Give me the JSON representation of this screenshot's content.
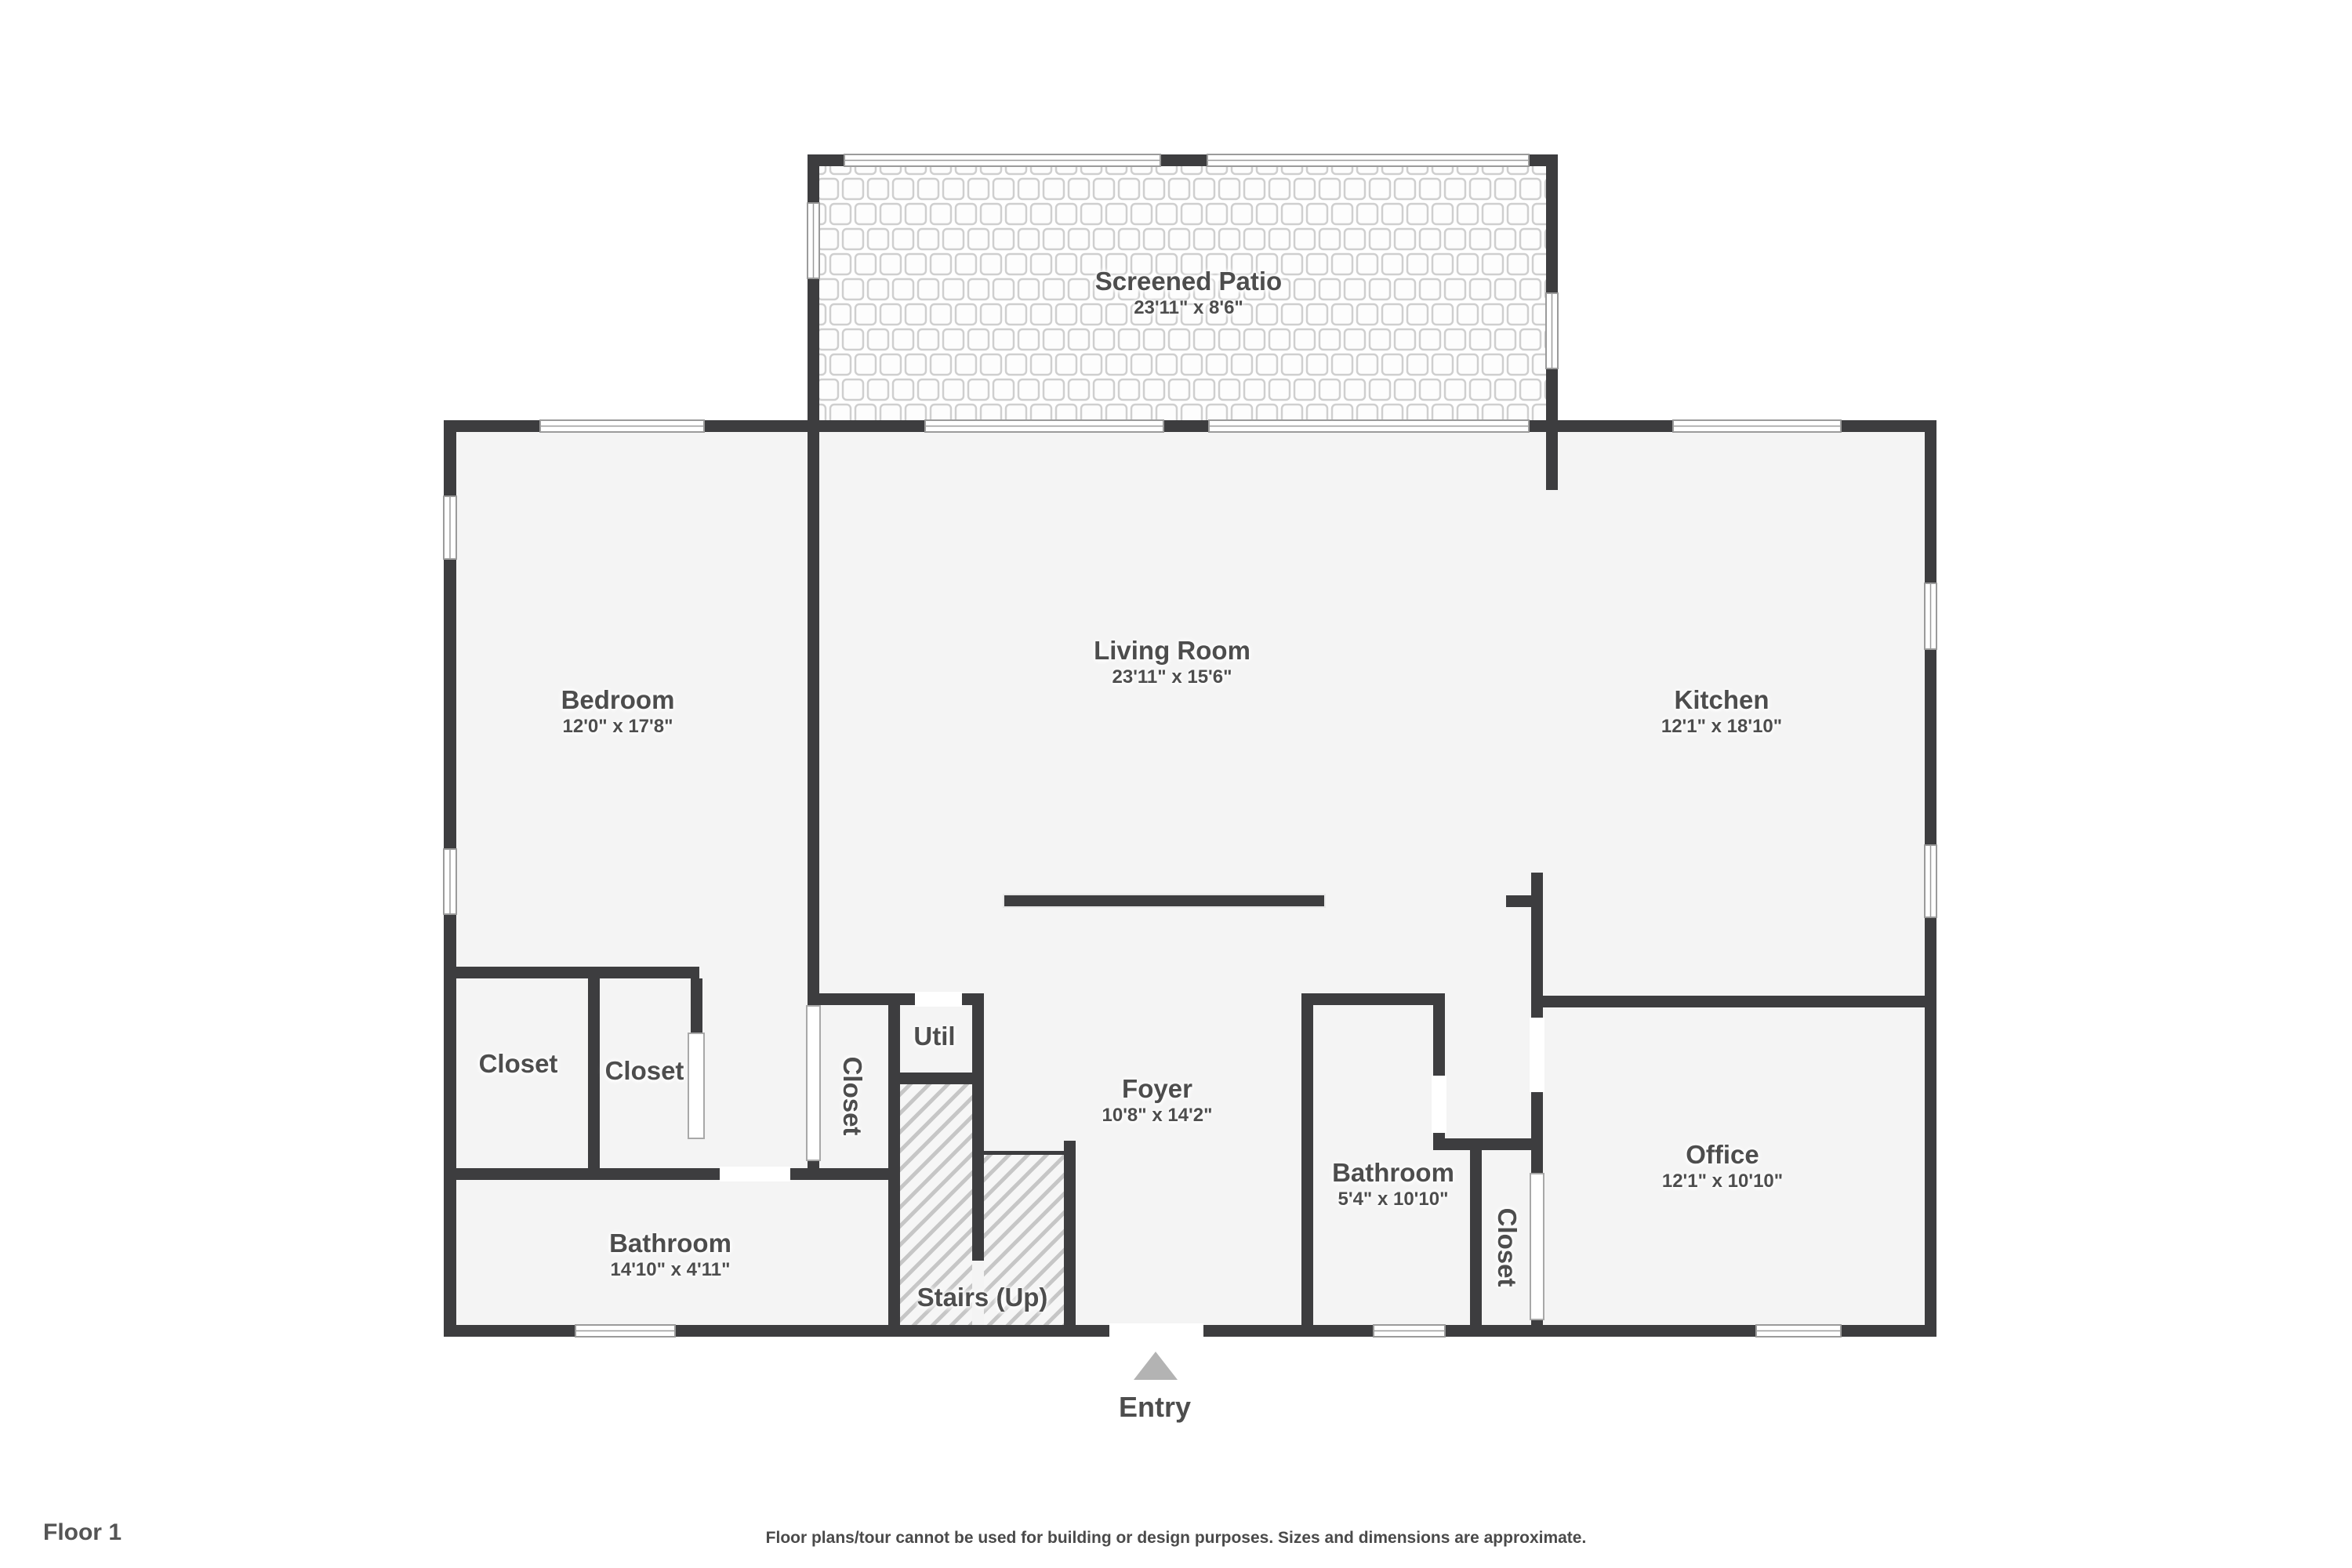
{
  "floor_label": "Floor 1",
  "disclaimer": "Floor plans/tour cannot be used for building or design purposes. Sizes and dimensions are approximate.",
  "entry": {
    "label": "Entry"
  },
  "rooms": {
    "screened_patio": {
      "name": "Screened Patio",
      "dims": "23'11\" x 8'6\""
    },
    "bedroom": {
      "name": "Bedroom",
      "dims": "12'0\" x 17'8\""
    },
    "living_room": {
      "name": "Living Room",
      "dims": "23'11\" x 15'6\""
    },
    "kitchen": {
      "name": "Kitchen",
      "dims": "12'1\" x 18'10\""
    },
    "closet_1": {
      "name": "Closet"
    },
    "closet_2": {
      "name": "Closet"
    },
    "closet_hall": {
      "name": "Closet"
    },
    "util": {
      "name": "Util"
    },
    "foyer": {
      "name": "Foyer",
      "dims": "10'8\" x 14'2\""
    },
    "bathroom_main": {
      "name": "Bathroom",
      "dims": "14'10\" x 4'11\""
    },
    "bathroom_2": {
      "name": "Bathroom",
      "dims": "5'4\" x 10'10\""
    },
    "closet_office": {
      "name": "Closet"
    },
    "office": {
      "name": "Office",
      "dims": "12'1\" x 10'10\""
    },
    "stairs": {
      "name": "Stairs (Up)"
    }
  },
  "colors": {
    "wall": "#3d3d3f",
    "floor": "#f4f4f4",
    "text": "#4d4d4d",
    "entry_arrow": "#b3b3b3",
    "hatch_line": "#c6c6c6",
    "mesh_line": "#cfcfcf"
  }
}
